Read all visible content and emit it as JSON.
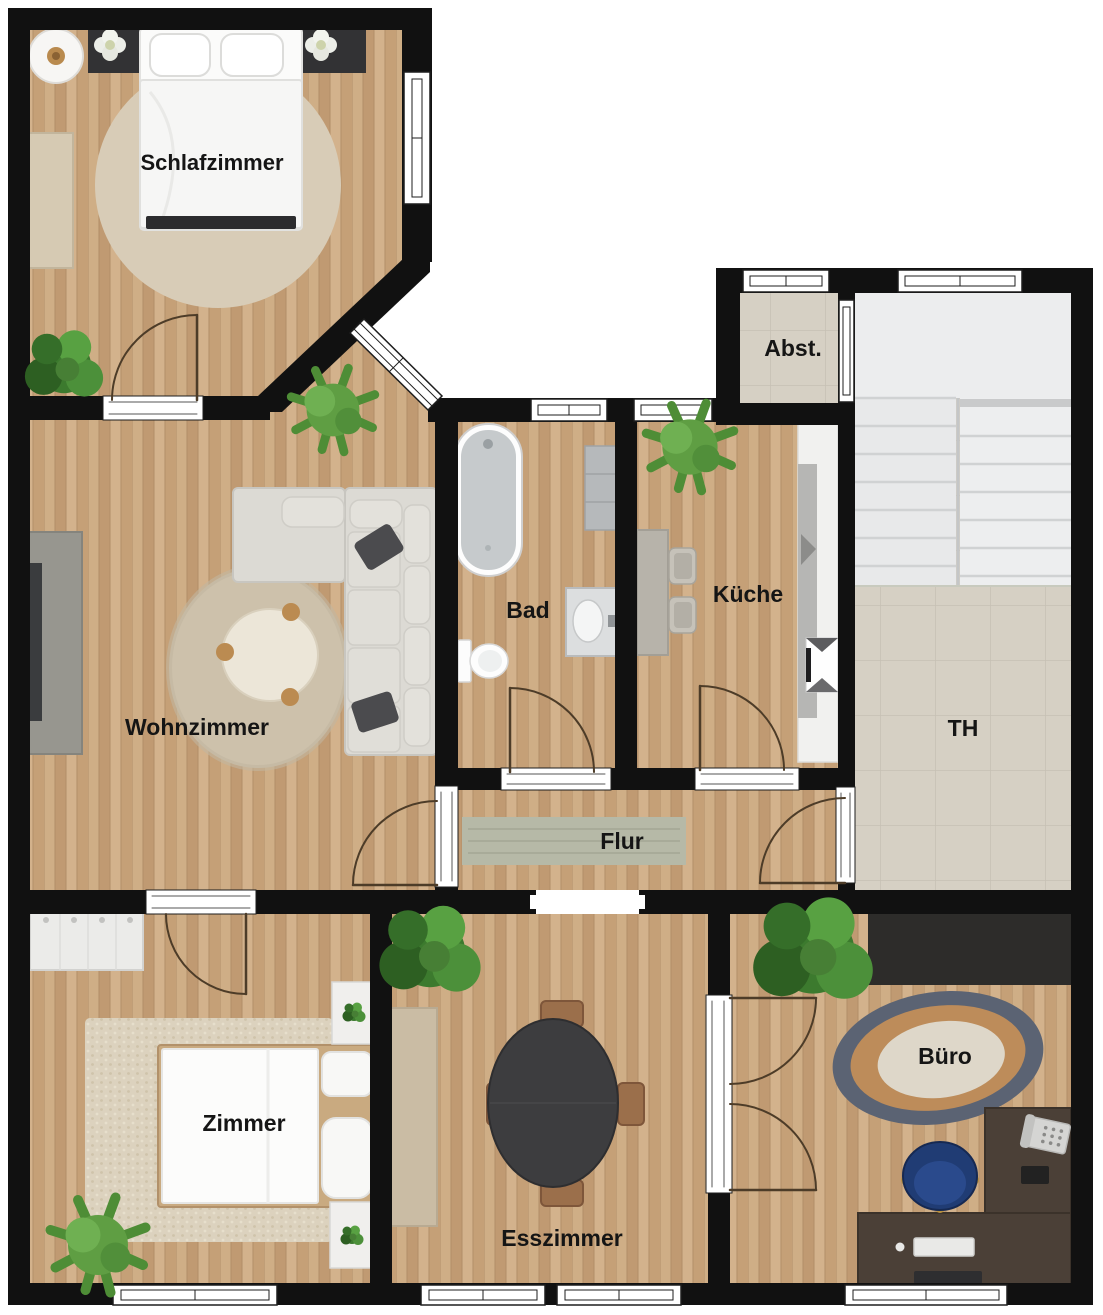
{
  "floorplan": {
    "rooms": [
      {
        "id": "schlafzimmer",
        "label": "Schlafzimmer"
      },
      {
        "id": "wohnzimmer",
        "label": "Wohnzimmer"
      },
      {
        "id": "bad",
        "label": "Bad"
      },
      {
        "id": "kueche",
        "label": "Küche"
      },
      {
        "id": "abstellraum",
        "label": "Abst."
      },
      {
        "id": "treppenhaus",
        "label": "TH"
      },
      {
        "id": "flur",
        "label": "Flur"
      },
      {
        "id": "zimmer",
        "label": "Zimmer"
      },
      {
        "id": "esszimmer",
        "label": "Esszimmer"
      },
      {
        "id": "buero",
        "label": "Büro"
      }
    ],
    "colors": {
      "wall": "#111111",
      "wood_floor": "#c8a47d",
      "tile_floor": "#d6d0c4",
      "exterior": "#ffffff",
      "door_swing": "#4d3c28",
      "label_text": "#151515",
      "sofa": "#dcdad4",
      "dining_table": "#3d3d3f",
      "office_chair": "#203c74",
      "desk": "#4b4037"
    }
  }
}
